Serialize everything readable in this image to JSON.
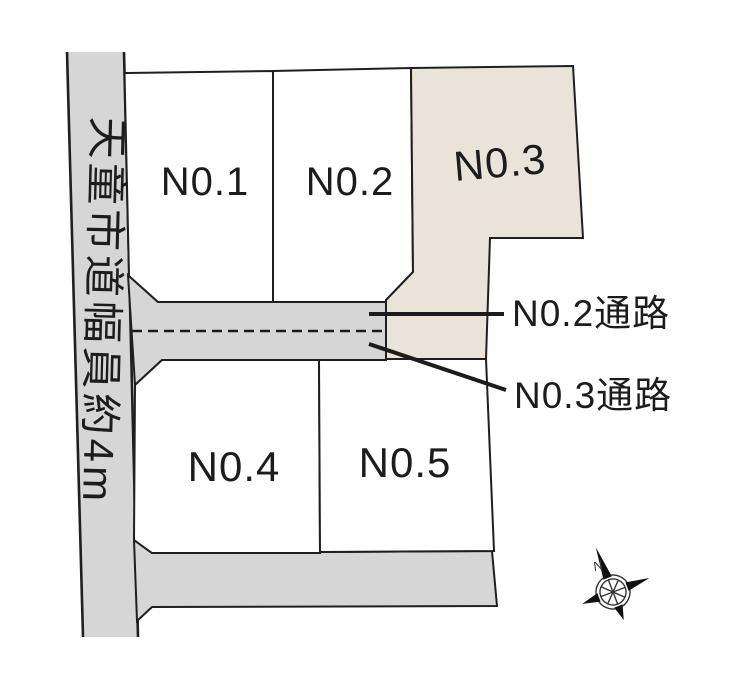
{
  "map": {
    "road_label": "天童市道幅員約4m",
    "lots": [
      {
        "label": "N0.1"
      },
      {
        "label": "N0.2"
      },
      {
        "label": "N0.3"
      },
      {
        "label": "N0.4"
      },
      {
        "label": "N0.5"
      }
    ],
    "callouts": [
      {
        "label": "N0.2通路"
      },
      {
        "label": "N0.3通路"
      }
    ],
    "compass_north": "N"
  },
  "colors": {
    "road": "#d6d6d6",
    "lot": "#ffffff",
    "lot3": "#eae3da",
    "line": "#1f1f1f"
  }
}
